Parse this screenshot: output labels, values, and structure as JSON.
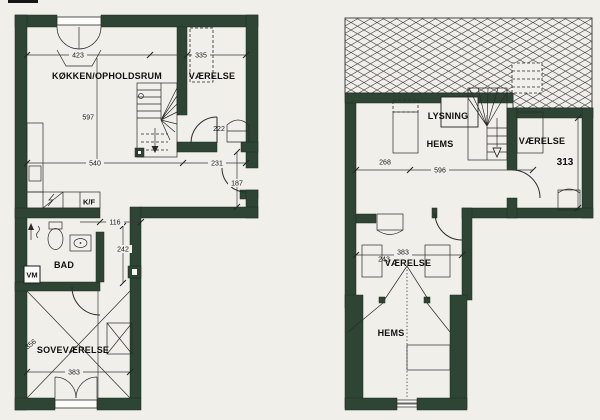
{
  "document": {
    "type": "scanned floor plan",
    "floors": 2
  },
  "colors": {
    "wall": "#2e4434",
    "paper": "#f1efe9",
    "line": "#2a2a2a",
    "hatch": "#4f4f4f"
  },
  "ground_floor": {
    "labels": {
      "kitchen": "KØKKEN/OPHOLDSRUM",
      "room": "VÆRELSE",
      "bath": "BAD",
      "bedroom": "SOVEVÆRELSE",
      "fridge": "K/F",
      "washer": "VM"
    },
    "dims": {
      "d423": "423",
      "d335": "335",
      "d597": "597",
      "d540": "540",
      "d231": "231",
      "d222": "222",
      "d187": "187",
      "d116": "116",
      "d242": "242",
      "d356": "356",
      "d383": "383"
    }
  },
  "upper_floor": {
    "labels": {
      "lysning": "LYSNING",
      "hems_upper": "HEMS",
      "room_upper": "VÆRELSE",
      "room_lower": "VÆRELSE",
      "hems_lower": "HEMS"
    },
    "dims": {
      "d268": "268",
      "d596": "596",
      "d313": "313",
      "d383": "383",
      "d243": "243"
    }
  }
}
